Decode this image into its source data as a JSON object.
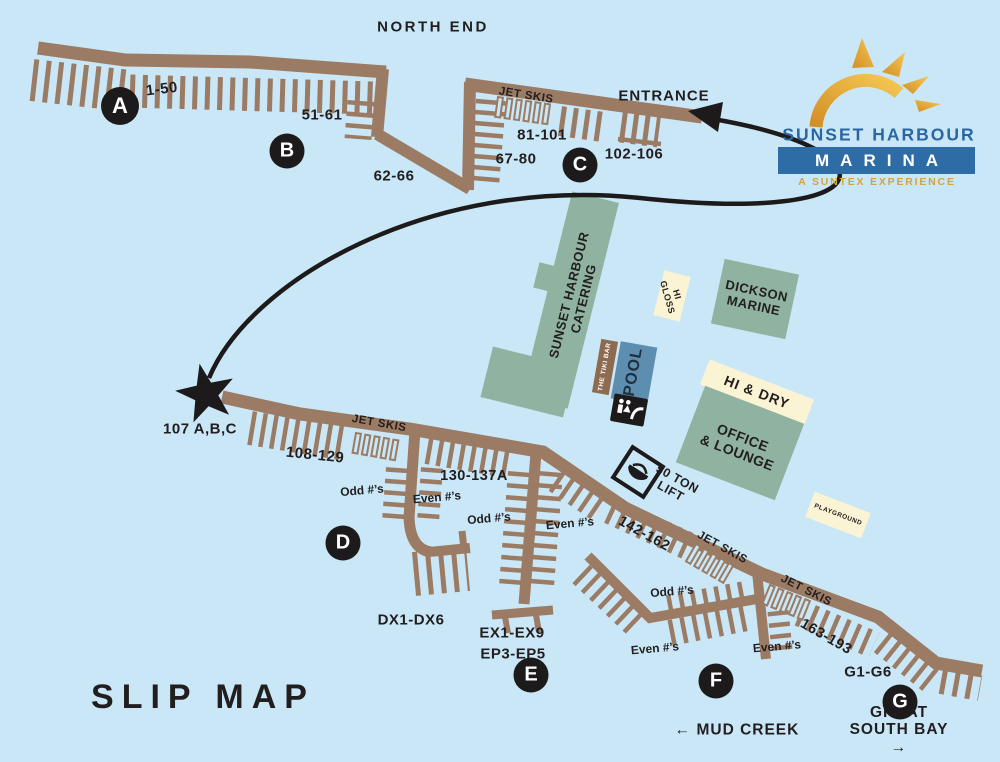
{
  "title": "Sunset Harbour Marina Slip Map",
  "colors": {
    "water": "#C9E7F7",
    "dock_brown": "#9B7B63",
    "ink": "#221E1F",
    "badge_bg": "#1D1A1B",
    "building_green": "#8FB3A0",
    "building_cream": "#FAF3D4",
    "pool_blue": "#5E8EAF",
    "tiki_brown": "#8D6B51",
    "logo_blue": "#2A66A4",
    "logo_bar_blue": "#2E6CA6",
    "logo_gold": "#D9A13C",
    "sun_gold_dark": "#D28E24",
    "sun_gold_light": "#F5C753"
  },
  "logo": {
    "name": "SUNSET HARBOUR",
    "marina": "MARINA",
    "tagline": "A SUNTEX EXPERIENCE"
  },
  "icons": {
    "sun": "sun-logo-icon",
    "star": "location-star-icon",
    "arrow": "entrance-route-arrow",
    "lift": "boat-lift-icon",
    "restroom": "restroom-icon",
    "jet_ski_slots": "jet-ski-slot-racks"
  },
  "dock_badges": [
    {
      "letter": "A",
      "x": 120,
      "y": 106,
      "d": 38
    },
    {
      "letter": "B",
      "x": 287,
      "y": 151,
      "d": 35
    },
    {
      "letter": "C",
      "x": 580,
      "y": 165,
      "d": 35
    },
    {
      "letter": "D",
      "x": 343,
      "y": 543,
      "d": 35
    },
    {
      "letter": "E",
      "x": 531,
      "y": 675,
      "d": 35
    },
    {
      "letter": "F",
      "x": 716,
      "y": 681,
      "d": 35
    },
    {
      "letter": "G",
      "x": 900,
      "y": 702,
      "d": 35
    }
  ],
  "labels": [
    {
      "name": "north-end-label",
      "text": "NORTH END",
      "x": 433,
      "y": 28,
      "rot": 0,
      "size": 15,
      "ls": 2.5
    },
    {
      "name": "slips-1-50",
      "text": "1-50",
      "x": 162,
      "y": 90,
      "rot": -7,
      "size": 15,
      "ls": 0.5
    },
    {
      "name": "slips-51-61",
      "text": "51-61",
      "x": 322,
      "y": 116,
      "rot": 0,
      "size": 15,
      "ls": 0.5
    },
    {
      "name": "slips-62-66",
      "text": "62-66",
      "x": 394,
      "y": 177,
      "rot": 0,
      "size": 15,
      "ls": 0.5
    },
    {
      "name": "jet-skis-c-label",
      "text": "JET SKIS",
      "x": 526,
      "y": 96,
      "rot": 9,
      "size": 11.5,
      "ls": 0.5
    },
    {
      "name": "slips-81-101",
      "text": "81-101",
      "x": 542,
      "y": 136,
      "rot": 0,
      "size": 15,
      "ls": 0.5
    },
    {
      "name": "slips-67-80",
      "text": "67-80",
      "x": 516,
      "y": 160,
      "rot": 0,
      "size": 15,
      "ls": 0.5
    },
    {
      "name": "slips-102-106",
      "text": "102-106",
      "x": 634,
      "y": 155,
      "rot": 0,
      "size": 15,
      "ls": 0.5
    },
    {
      "name": "entrance-label",
      "text": "ENTRANCE",
      "x": 664,
      "y": 97,
      "rot": 0,
      "size": 15,
      "ls": 1
    },
    {
      "name": "slips-107-abc",
      "text": "107 A,B,C",
      "x": 200,
      "y": 430,
      "rot": 0,
      "size": 15,
      "ls": 0.5
    },
    {
      "name": "slips-108-129",
      "text": "108-129",
      "x": 315,
      "y": 456,
      "rot": 6,
      "size": 15,
      "ls": 0.5
    },
    {
      "name": "jet-skis-main-label",
      "text": "JET SKIS",
      "x": 379,
      "y": 424,
      "rot": 10,
      "size": 11.5,
      "ls": 0.5
    },
    {
      "name": "odd-numbers-d",
      "text": "Odd #’s",
      "x": 362,
      "y": 491,
      "rot": -5,
      "size": 12,
      "ls": 0
    },
    {
      "name": "even-numbers-d",
      "text": "Even #’s",
      "x": 437,
      "y": 498,
      "rot": -5,
      "size": 12,
      "ls": 0
    },
    {
      "name": "slips-130-137a",
      "text": "130-137A",
      "x": 474,
      "y": 476,
      "rot": 0,
      "size": 14.5,
      "ls": 0.5
    },
    {
      "name": "odd-numbers-e",
      "text": "Odd #’s",
      "x": 489,
      "y": 519,
      "rot": -5,
      "size": 12,
      "ls": 0
    },
    {
      "name": "even-numbers-e",
      "text": "Even #’s",
      "x": 570,
      "y": 524,
      "rot": -5,
      "size": 12,
      "ls": 0
    },
    {
      "name": "slips-dx1-dx6",
      "text": "DX1-DX6",
      "x": 411,
      "y": 621,
      "rot": 0,
      "size": 15,
      "ls": 0.5
    },
    {
      "name": "slips-ex1-ex9",
      "text": "EX1-EX9",
      "x": 512,
      "y": 634,
      "rot": 0,
      "size": 15,
      "ls": 0.5
    },
    {
      "name": "slips-ep3-ep5",
      "text": "EP3-EP5",
      "x": 513,
      "y": 655,
      "rot": 0,
      "size": 15,
      "ls": 0.5
    },
    {
      "name": "lift-label",
      "text": "50 TON\nLIFT",
      "x": 674,
      "y": 485,
      "rot": 29,
      "size": 12.5,
      "ls": 0.5
    },
    {
      "name": "slips-142-162",
      "text": "142-162",
      "x": 644,
      "y": 534,
      "rot": 29,
      "size": 14.5,
      "ls": 0.5
    },
    {
      "name": "jet-skis-f1-label",
      "text": "JET SKIS",
      "x": 722,
      "y": 548,
      "rot": 29,
      "size": 11.5,
      "ls": 0.5
    },
    {
      "name": "jet-skis-f2-label",
      "text": "JET SKIS",
      "x": 806,
      "y": 591,
      "rot": 27,
      "size": 11.5,
      "ls": 0.5
    },
    {
      "name": "odd-numbers-f",
      "text": "Odd #’s",
      "x": 672,
      "y": 592,
      "rot": -5,
      "size": 12,
      "ls": 0
    },
    {
      "name": "even-numbers-f1",
      "text": "Even #’s",
      "x": 655,
      "y": 649,
      "rot": -5,
      "size": 12,
      "ls": 0
    },
    {
      "name": "even-numbers-f2",
      "text": "Even #’s",
      "x": 777,
      "y": 647,
      "rot": -5,
      "size": 12,
      "ls": 0
    },
    {
      "name": "slips-163-193",
      "text": "163-193",
      "x": 826,
      "y": 637,
      "rot": 30,
      "size": 14.5,
      "ls": 0.5
    },
    {
      "name": "slips-g1-g6",
      "text": "G1-G6",
      "x": 868,
      "y": 673,
      "rot": 0,
      "size": 15,
      "ls": 0.5
    },
    {
      "name": "mud-creek-label",
      "text": "← MUD  CREEK",
      "x": 737,
      "y": 730,
      "rot": 0,
      "size": 15.5,
      "ls": 1
    },
    {
      "name": "great-south-bay-label",
      "text": "GREAT SOUTH BAY →",
      "x": 899,
      "y": 730,
      "rot": 0,
      "size": 15.5,
      "ls": 1
    },
    {
      "name": "slip-map-title",
      "text": "SLIP MAP",
      "x": 203,
      "y": 697,
      "rot": 0,
      "size": 34,
      "ls": 8
    }
  ],
  "buildings": [
    {
      "name": "catering-building-main",
      "x": 570,
      "y": 300,
      "w": 48,
      "h": 212,
      "rot": 14,
      "bg": "#8FB3A0",
      "label": {
        "text": "SUNSET HARBOUR\nCATERING",
        "x": 577,
        "y": 297,
        "rot": -76,
        "size": 13,
        "ls": 0.5,
        "color": "#221E1F"
      }
    },
    {
      "name": "catering-building-arm",
      "x": 528,
      "y": 382,
      "w": 85,
      "h": 52,
      "rot": 14,
      "bg": "#8FB3A0"
    },
    {
      "name": "catering-building-notch",
      "x": 549,
      "y": 278,
      "w": 26,
      "h": 26,
      "rot": 14,
      "bg": "#8FB3A0"
    },
    {
      "name": "hi-gloss-building",
      "x": 672,
      "y": 296,
      "w": 27,
      "h": 46,
      "rot": 14,
      "bg": "#FAF3D4",
      "label": {
        "text": "HI\nGLOSS",
        "x": 672,
        "y": 296,
        "rot": 74,
        "size": 9,
        "ls": 0.5,
        "color": "#221E1F"
      }
    },
    {
      "name": "dickson-marine-building",
      "x": 755,
      "y": 299,
      "w": 76,
      "h": 66,
      "rot": 12,
      "bg": "#8FB3A0",
      "label": {
        "text": "DICKSON\nMARINE",
        "x": 755,
        "y": 299,
        "rot": 12,
        "size": 13,
        "ls": 0.5,
        "color": "#221E1F"
      }
    },
    {
      "name": "tiki-bar-building",
      "x": 605,
      "y": 367,
      "w": 17,
      "h": 54,
      "rot": 10,
      "bg": "#8D6B51",
      "label": {
        "text": "THE TIKI BAR",
        "x": 605,
        "y": 367,
        "rot": -80,
        "size": 6.5,
        "ls": 0.5,
        "color": "#FFFFFF"
      }
    },
    {
      "name": "pool-area",
      "x": 634,
      "y": 373,
      "w": 37,
      "h": 58,
      "rot": 10,
      "bg": "#5E8EAF",
      "label": {
        "text": "POOL",
        "x": 634,
        "y": 372,
        "rot": -80,
        "size": 16,
        "ls": 1,
        "color": "#1E2F3E"
      }
    },
    {
      "name": "hi-and-dry-banner",
      "x": 757,
      "y": 392,
      "w": 112,
      "h": 27,
      "rot": 21,
      "bg": "#FAF3D4",
      "label": {
        "text": "HI & DRY",
        "x": 757,
        "y": 392,
        "rot": 21,
        "size": 14,
        "ls": 1,
        "color": "#221E1F"
      }
    },
    {
      "name": "office-lounge-building",
      "x": 740,
      "y": 443,
      "w": 106,
      "h": 82,
      "rot": 21,
      "bg": "#8FB3A0",
      "label": {
        "text": "OFFICE\n& LOUNGE",
        "x": 740,
        "y": 445,
        "rot": 21,
        "size": 14,
        "ls": 0.5,
        "color": "#221E1F"
      }
    },
    {
      "name": "playground-area",
      "x": 838,
      "y": 515,
      "w": 60,
      "h": 27,
      "rot": 21,
      "bg": "#FAF3D4",
      "label": {
        "text": "PLAYGROUND",
        "x": 838,
        "y": 515,
        "rot": 21,
        "size": 6.5,
        "ls": 0.5,
        "color": "#221E1F"
      }
    }
  ]
}
